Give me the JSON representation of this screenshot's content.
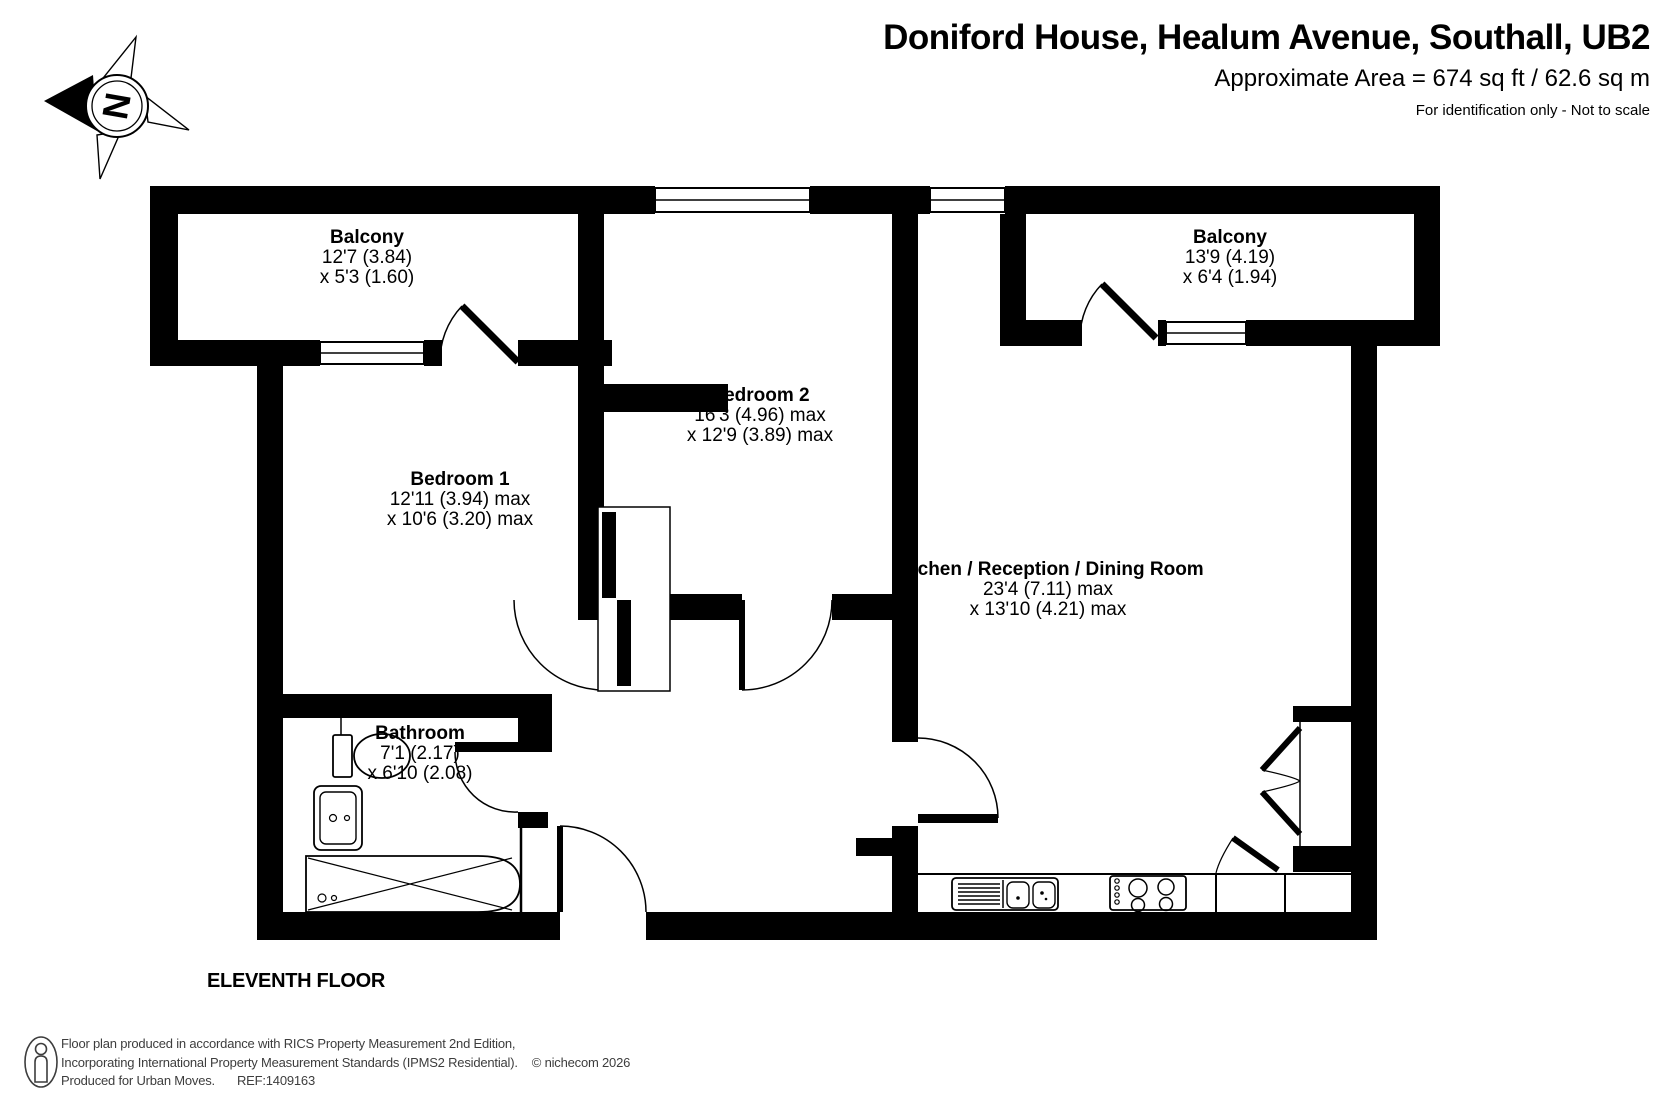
{
  "header": {
    "title": "Doniford House, Healum Avenue, Southall, UB2",
    "area": "Approximate Area = 674 sq ft / 62.6 sq m",
    "note": "For identification only - Not to scale"
  },
  "compass": {
    "label": "N"
  },
  "floor_label": "ELEVENTH FLOOR",
  "rooms": [
    {
      "id": "balcony-left",
      "name": "Balcony",
      "dim1": "12'7 (3.84)",
      "dim2": "x 5'3 (1.60)"
    },
    {
      "id": "balcony-right",
      "name": "Balcony",
      "dim1": "13'9 (4.19)",
      "dim2": "x 6'4 (1.94)"
    },
    {
      "id": "bedroom-2",
      "name": "Bedroom 2",
      "dim1": "16'3 (4.96)  max",
      "dim2": "x 12'9 (3.89) max"
    },
    {
      "id": "bedroom-1",
      "name": "Bedroom 1",
      "dim1": "12'11 (3.94) max",
      "dim2": "x 10'6 (3.20) max"
    },
    {
      "id": "kitchen",
      "name": "Kitchen / Reception / Dining Room",
      "dim1": "23'4 (7.11) max",
      "dim2": "x 13'10 (4.21) max"
    },
    {
      "id": "bathroom",
      "name": "Bathroom",
      "dim1": "7'1 (2.17)",
      "dim2": "x 6'10 (2.08)"
    }
  ],
  "footer": {
    "line1": "Floor plan produced in accordance with RICS Property Measurement 2nd Edition,",
    "line2": "Incorporating International Property Measurement Standards (IPMS2 Residential).",
    "copyright": "© nichecom 2026",
    "line3": "Produced for Urban Moves.",
    "ref": "REF:1409163"
  },
  "colors": {
    "wall": "#000000",
    "text": "#000000",
    "footer_text": "#3d3d3d"
  }
}
